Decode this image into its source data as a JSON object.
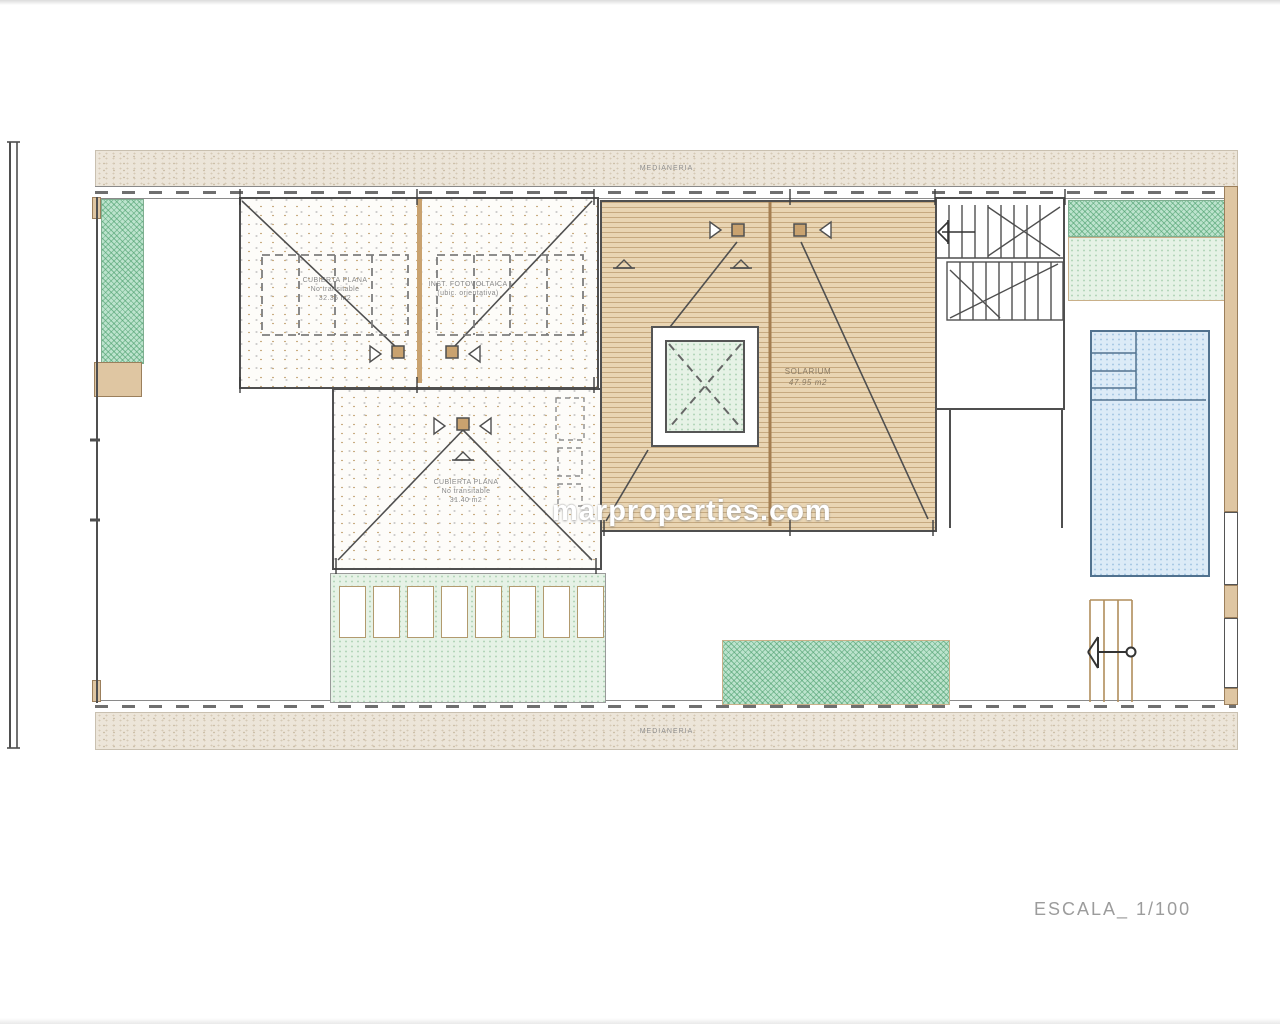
{
  "plan": {
    "boundary": {
      "top_label": "MEDIANERIA",
      "bottom_label": "MEDIANERIA"
    },
    "labels": {
      "roof_left": {
        "line1": "CUBIERTA PLANA",
        "line2": "No transitable",
        "line3": "32.36 m2"
      },
      "roof_pv": {
        "line1": "INST. FOTOVOLTAICA",
        "line2": "(ubic. orientativa)"
      },
      "roof_lower": {
        "line1": "CUBIERTA PLANA",
        "line2": "No transitable",
        "line3": "31.40 m2"
      },
      "solarium": {
        "line1": "SOLARIUM",
        "line2": "47.95 m2"
      }
    },
    "scale_label": "ESCALA_ 1/100",
    "watermark": "marproperties.com",
    "colors": {
      "deck_tan": "#e9d5b3",
      "deck_line": "#b08d5c",
      "wall_tan": "#dfc6a2",
      "green_hatch": "#bce3cd",
      "green_light": "#e6f2e6",
      "pool_blue": "#dcebf7",
      "line_dark": "#4f4f4f",
      "label_gray": "#8a8a8a"
    }
  }
}
